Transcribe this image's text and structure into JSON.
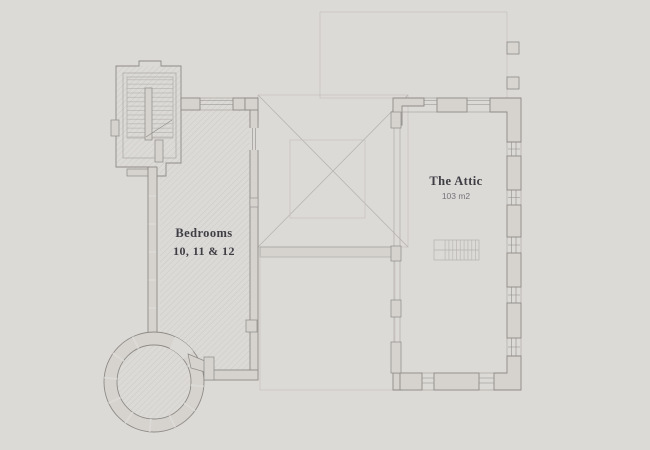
{
  "colors": {
    "background": "#dcdad7",
    "wall_fill": "#d6d3cf",
    "wall_stroke": "#8e8b87",
    "hatch_line": "#c9c6c3",
    "label_text": "#3f3e44",
    "muted_text": "#74737a"
  },
  "floorplan": {
    "attic": {
      "name": "The Attic",
      "area": "103 m2"
    },
    "bedrooms": {
      "name": "Bedrooms",
      "numbers": "10, 11 & 12"
    }
  }
}
